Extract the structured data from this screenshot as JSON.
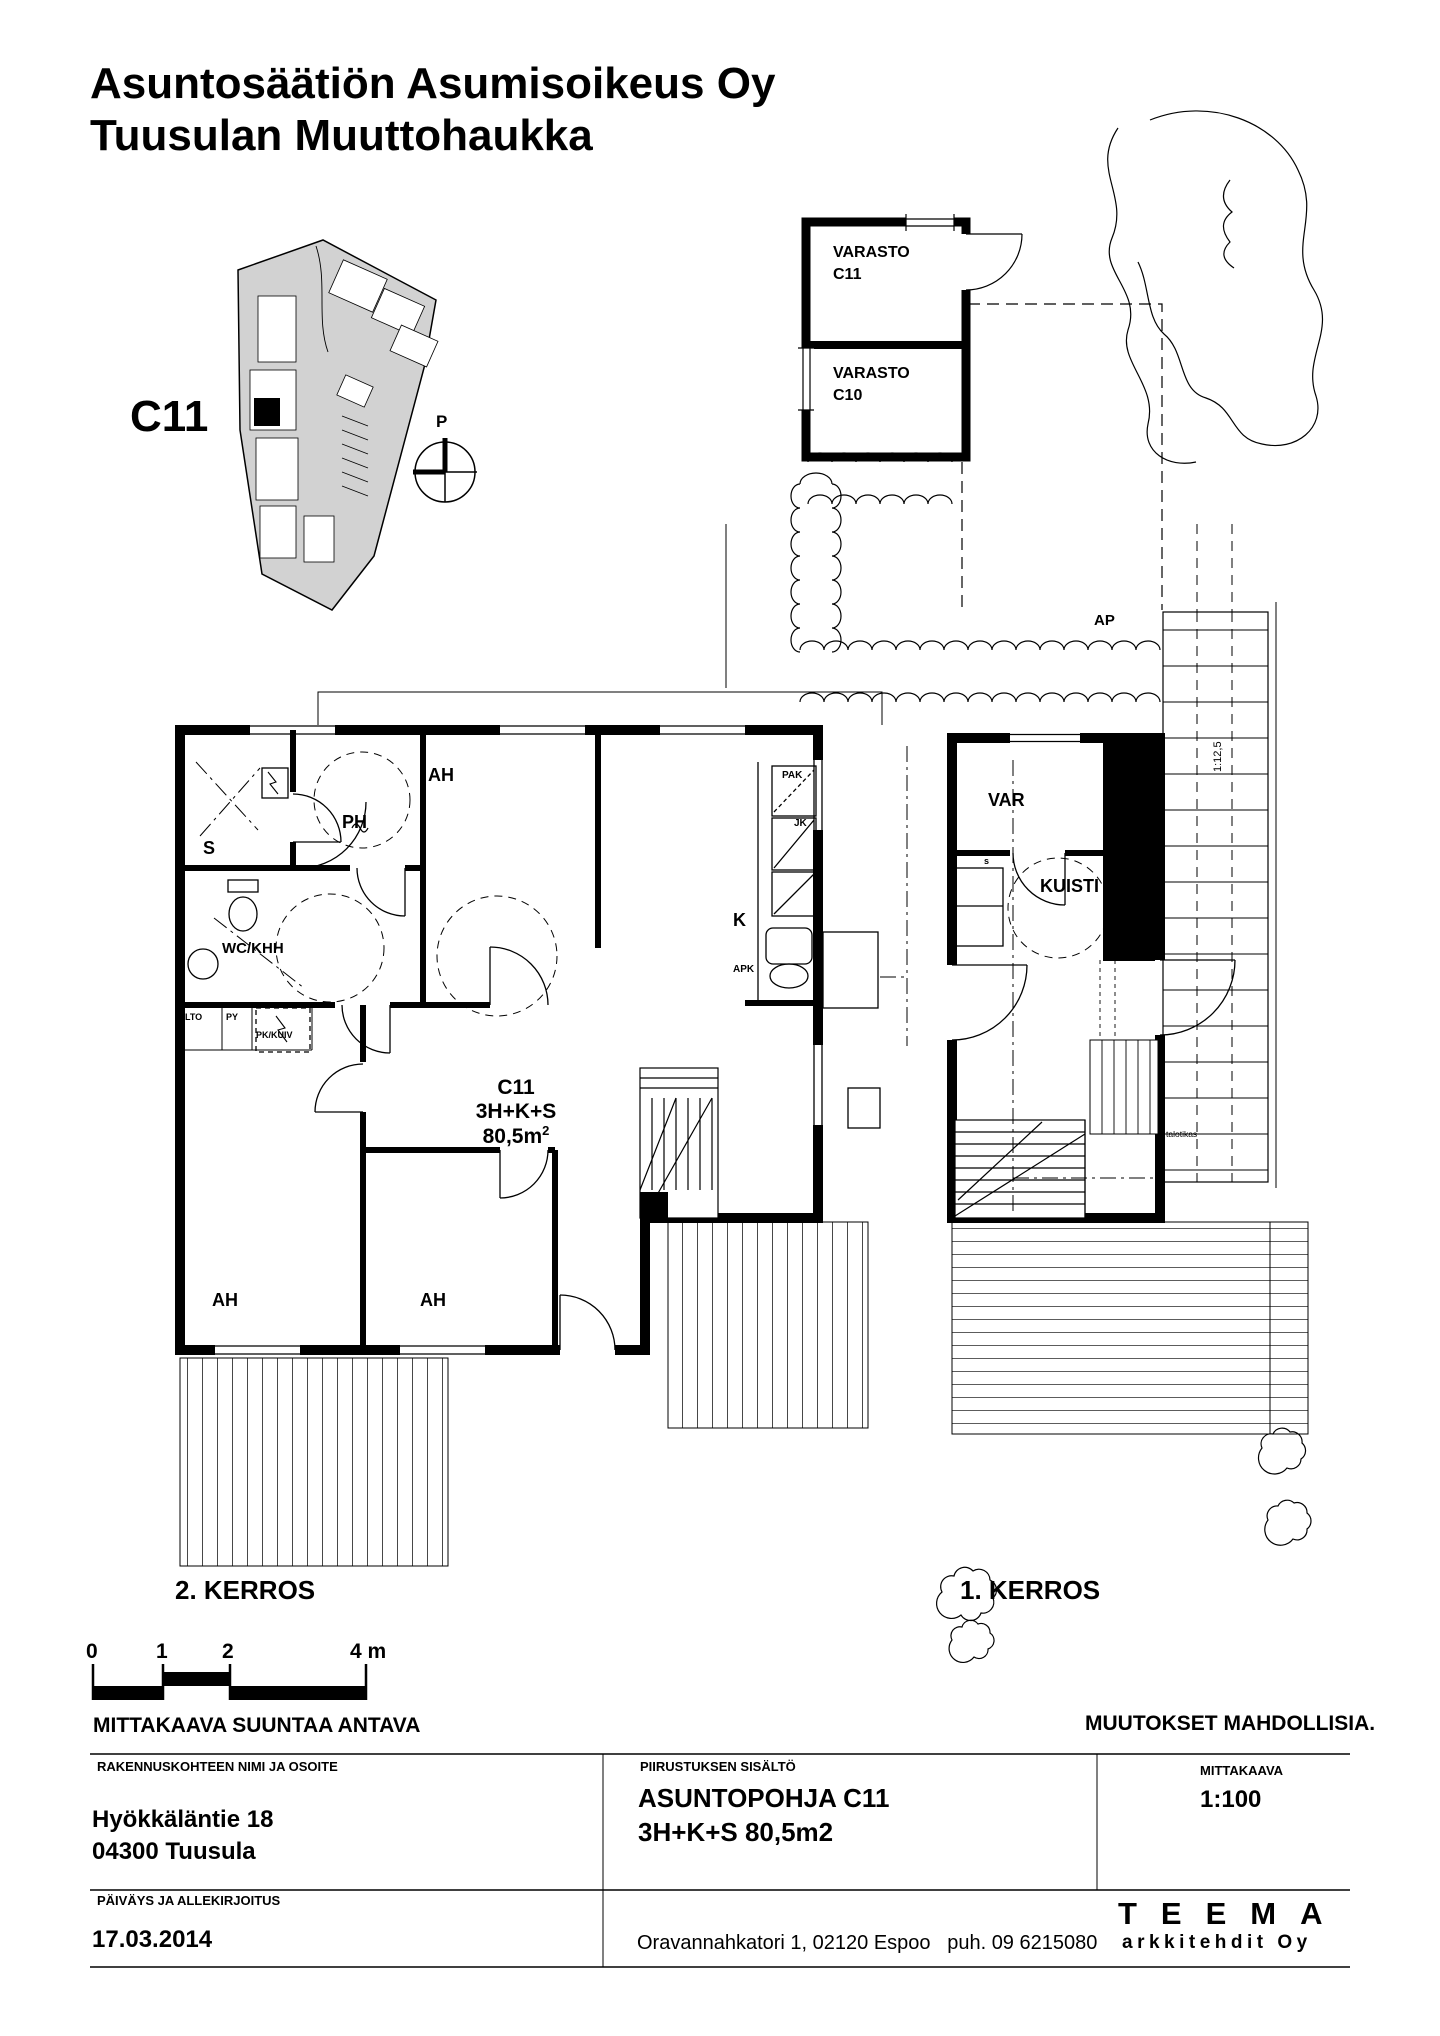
{
  "page": {
    "bg": "#ffffff",
    "ink": "#000000",
    "site_fill": "#d2d2d2"
  },
  "header": {
    "title_line1": "Asuntosäätiön Asumisoikeus Oy",
    "title_line2": "Tuusulan Muuttohaukka"
  },
  "site_plan": {
    "unit_label": "C11",
    "north_label": "P"
  },
  "storage": {
    "room1_line1": "VARASTO",
    "room1_line2": "C11",
    "room2_line1": "VARASTO",
    "room2_line2": "C10"
  },
  "floor2": {
    "name": "2. KERROS",
    "rooms": {
      "ah_top": "AH",
      "ph": "PH",
      "sauna": "S",
      "wc": "WC/KHH",
      "kitchen": "K",
      "ah_bottom_left": "AH",
      "ah_bottom_mid": "AH"
    },
    "fixtures": {
      "pak": "PAK",
      "jk": "JK",
      "apk": "APK",
      "lto": "LTO",
      "py": "PY",
      "pkkuiv": "PK/KUIV"
    },
    "apartment": {
      "id": "C11",
      "type": "3H+K+S",
      "area": "80,5m",
      "area_sup": "2"
    }
  },
  "floor1": {
    "name": "1. KERROS",
    "rooms": {
      "var": "VAR",
      "kuisti": "KUISTI",
      "closet": "s"
    },
    "labels": {
      "parking": "AP",
      "ramp_slope": "1:12,5",
      "ladder": "talotikas"
    }
  },
  "scale_bar": {
    "tick0": "0",
    "tick1": "1",
    "tick2": "2",
    "tick4": "4 m"
  },
  "notes": {
    "scale_note": "MITTAKAAVA SUUNTAA ANTAVA",
    "changes_note": "MUUTOKSET MAHDOLLISIA."
  },
  "title_block": {
    "col1_header": "RAKENNUSKOHTEEN NIMI JA OSOITE",
    "address_line1": "Hyökkäläntie 18",
    "address_line2": "04300 Tuusula",
    "col2_header": "PIIRUSTUKSEN SISÄLTÖ",
    "drawing_title": "ASUNTOPOHJA C11",
    "drawing_subtitle": "3H+K+S 80,5m2",
    "col3_header": "MITTAKAAVA",
    "scale_value": "1:100",
    "row2_header": "PÄIVÄYS JA ALLEKIRJOITUS",
    "date": "17.03.2014",
    "office_address": "Oravannahkatori 1, 02120 Espoo   puh. 09 6215080",
    "logo_name": "TEEMA",
    "logo_sub": "arkkitehdit Oy"
  }
}
